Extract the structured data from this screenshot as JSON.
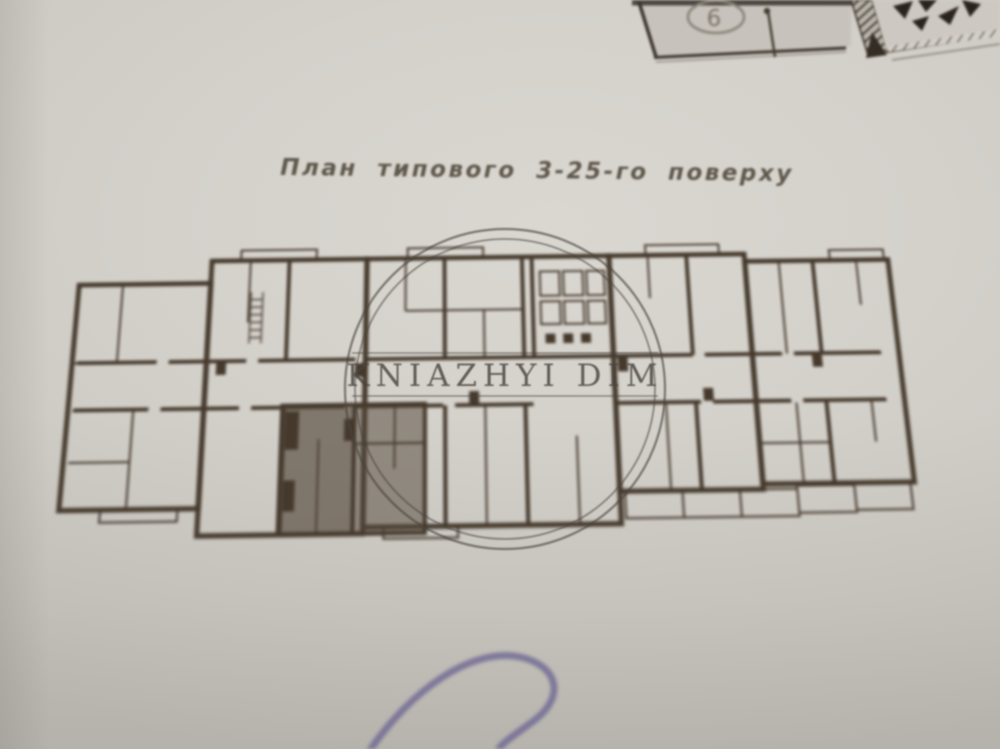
{
  "photo": {
    "title": "План  типового  3-25-го  поверху",
    "watermark": {
      "text": "KNIAZHYI DIM"
    },
    "corner_sheet": {
      "room_number": "6"
    },
    "colors": {
      "paper": "#d2cfc9",
      "wall_ink": "#45392c",
      "highlight_room": "#55493c",
      "watermark_ink": "#4a443e",
      "pen_ink": "#6d6792",
      "title_ink": "#5f584c"
    }
  }
}
